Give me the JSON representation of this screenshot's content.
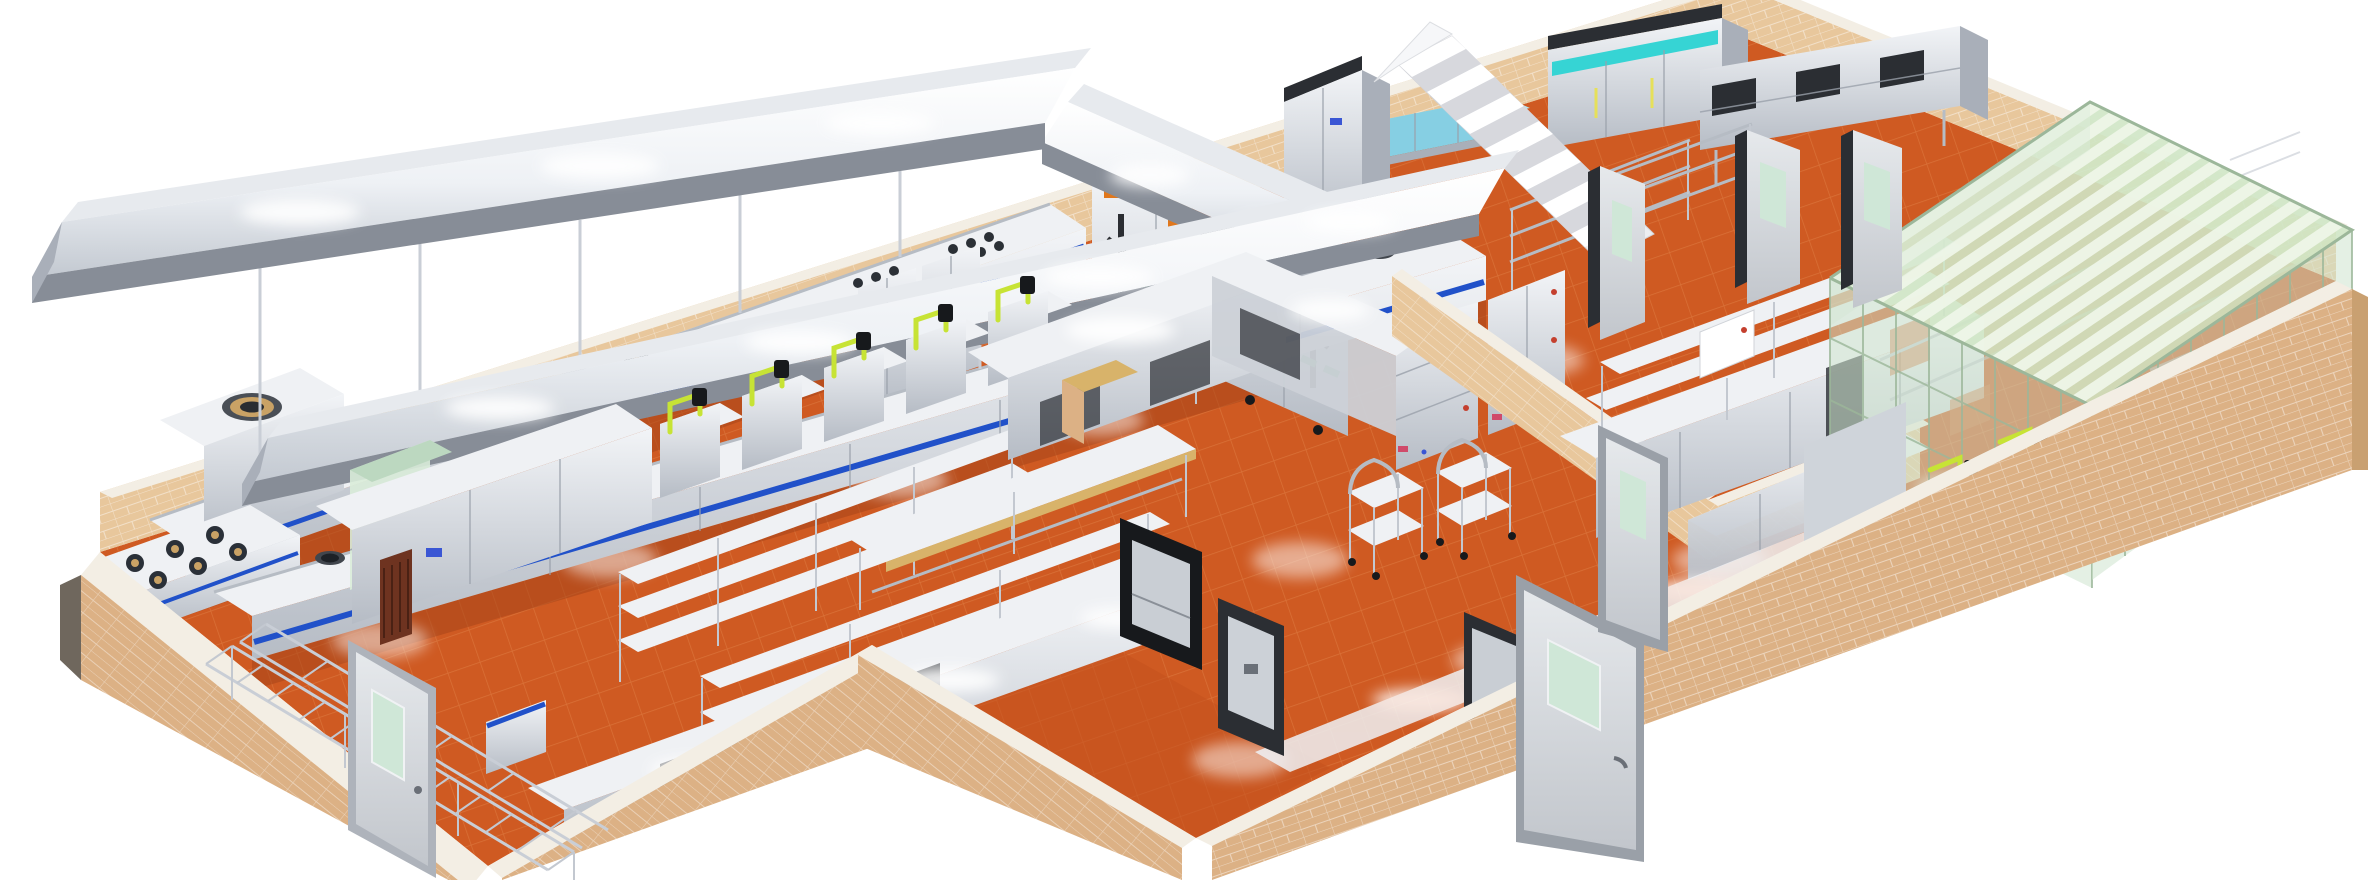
{
  "canvas": {
    "width": 2368,
    "height": 880
  },
  "scene": {
    "type": "3d-isometric-render",
    "subject": "commercial-kitchen-plan",
    "background": "white"
  },
  "palette": {
    "bg": "#ffffff",
    "floor": "#cf5a22",
    "floorLine": "#e2854a",
    "floorDark": "#a8451a",
    "vestFloor": "#c4521e",
    "wall": "#e8c79c",
    "wallFace": "#dcb185",
    "wallSide": "#c9a071",
    "wallCap": "#f3eee4",
    "steelTop": "#eff1f4",
    "steel": "#ccd1d7",
    "steelMid": "#a9afb9",
    "steelDark": "#7e848f",
    "hoodUnder": "#878d97",
    "blue": "#2151c9",
    "teal": "#36d4d4",
    "water": "#86cfe3",
    "waterTop": "#b7e7f1",
    "pipe": "#c7e335",
    "glassRoof": "#cfe5c5",
    "glassStripe": "#eef6e8",
    "glassWall": "rgba(205,228,205,0.55)",
    "glassWall2": "rgba(219,236,218,0.45)",
    "glassEdge": "#9cb79a",
    "labelOrange": "#e0771c",
    "stripeGreen": "#3da45d",
    "dark": "#17191c",
    "frameDark": "#2b2e33",
    "door": "#d9dce0",
    "doorWindow": "#cfe7d7",
    "maroon": "#6e3320",
    "wood": "#d8b36a",
    "brass": "#c9a265",
    "red": "#c43f2e",
    "pink": "#d04a6a",
    "blueDot": "#3a56d4"
  },
  "zones": [
    {
      "name": "hot-kitchen-left",
      "equipment": [
        "exhaust-hood-canopy",
        "rear-cook-line",
        "gas-range-6-burner",
        "big-wok-stove",
        "wok-line",
        "pipe-stations",
        "shelving-racks",
        "worktables",
        "refrigerated-counter",
        "ladder-rack",
        "green-display-cabinet"
      ]
    },
    {
      "name": "center-block",
      "equipment": [
        "steam-cabinet-bank",
        "tall-refrigerator",
        "staircase",
        "fish-tank",
        "l-shaped-counter",
        "drawer-cabinets",
        "service-trolleys",
        "dumbwaiters",
        "front-counter"
      ]
    },
    {
      "name": "right-wing",
      "equipment": [
        "corridor-doors",
        "wire-shelving",
        "wall-cabinet-bank",
        "refrigerator-teal-bank",
        "prep-counter-overshelf",
        "glass-enclosed-room",
        "wok-counter",
        "walkway-strip"
      ]
    }
  ],
  "inventory": {
    "wok_burners_second_line": 8,
    "wok_rings_rear_line": 2,
    "big_wok_stove_rings": 1,
    "gas_range_burners": 6,
    "steam_cabinet_doors": 4,
    "pipe_stations": 5,
    "service_trolleys": 2,
    "dumbwaiters": 3,
    "doors": 6,
    "glass_roof_stripes": 13,
    "teal_refrigerator_doors": 3,
    "floor_light_blooms": 11
  }
}
